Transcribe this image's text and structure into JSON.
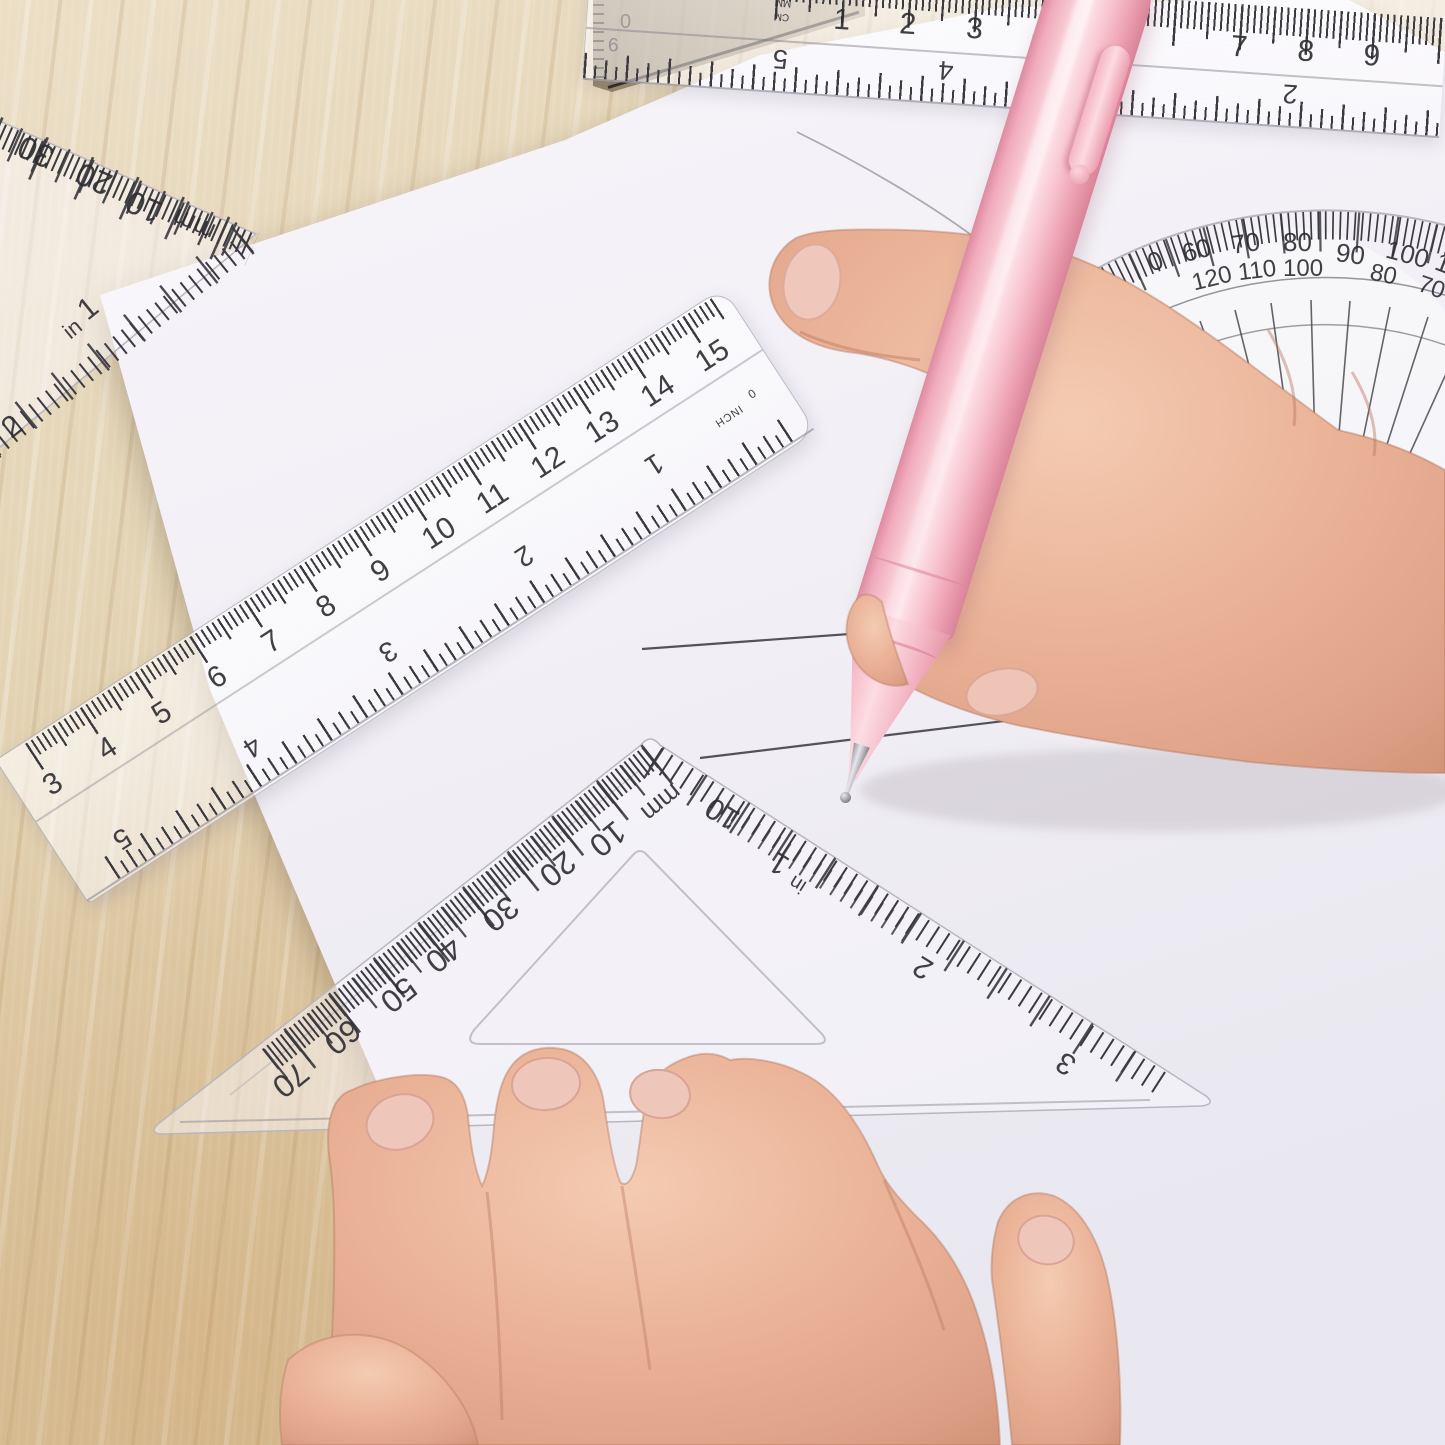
{
  "photo": {
    "description": "Hand drawing with a pink pen on paper using clear plastic rulers, set squares and a protractor on a wooden desk"
  },
  "colors": {
    "pen_pink": "#f3b7c4",
    "wood_tan": "#dccaa9",
    "paper_white": "#f2f0f6",
    "skin_tone": "#e6ac90",
    "marking_ink": "#2c2c31"
  },
  "top_ruler": {
    "cm_numbers": [
      "1",
      "2",
      "3",
      "4",
      "5",
      "7",
      "8",
      "9"
    ],
    "inch_numbers": [
      "5",
      "4",
      "3",
      "2"
    ],
    "legend_mm": "MM",
    "legend_cm": "CM"
  },
  "ruler_end_piece": {
    "zero": "0",
    "nine": "9"
  },
  "diagonal_ruler": {
    "cm_numbers": [
      "3",
      "4",
      "5",
      "6",
      "7",
      "8",
      "9",
      "10",
      "11",
      "12",
      "13",
      "14",
      "15"
    ],
    "inch_numbers": [
      "1",
      "2",
      "3",
      "4",
      "5"
    ],
    "end_zero": "0",
    "end_unit": "INCH"
  },
  "top_left_square": {
    "mm_numbers": [
      "30",
      "20",
      "10"
    ],
    "mm_unit": "mm",
    "inch_label_1": "1",
    "inch_unit": "in",
    "inch_label_2": "2"
  },
  "bottom_square": {
    "mm_unit": "mm",
    "mm_numbers": [
      "10",
      "20",
      "30",
      "40",
      "50",
      "60",
      "70"
    ],
    "corner_number": "10",
    "inch_label_1": "1",
    "inch_unit": "in",
    "inch_label_2": "2",
    "inch_label_3": "3"
  },
  "protractor": {
    "outer_numbers": [
      "0",
      "60",
      "70",
      "80",
      "90",
      "100",
      "1"
    ],
    "inner_numbers": [
      "120",
      "110",
      "100",
      "80",
      "70"
    ]
  }
}
